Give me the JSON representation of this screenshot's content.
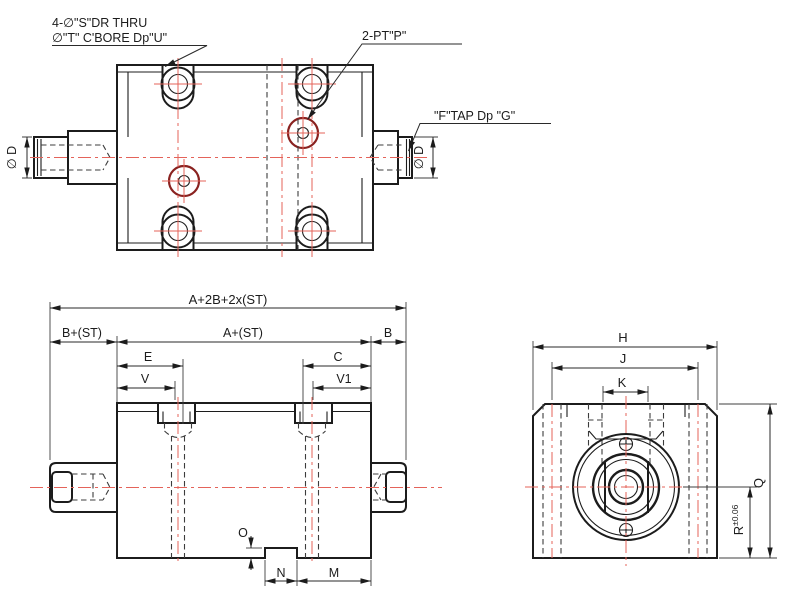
{
  "colors": {
    "line": "#1c1c1c",
    "centerline": "#e4635a",
    "hidden_line": "#3c3c3c",
    "port_highlight": "#8a2220",
    "background": "#ffffff"
  },
  "top_view": {
    "drill_note_line1": "4-∅\"S\"DR THRU",
    "drill_note_line2": "∅\"T\" C'BORE Dp\"U\"",
    "port_note": "2-PT\"P\"",
    "tap_note": "\"F\"TAP Dp \"G\"",
    "dia_label_left": "∅ D",
    "dia_label_right": "∅ D"
  },
  "front_view": {
    "dim_total": "A+2B+2x(ST)",
    "dim_left_end": "B+(ST)",
    "dim_body": "A+(ST)",
    "dim_right_end": "B",
    "dim_e": "E",
    "dim_c": "C",
    "dim_v": "V",
    "dim_v1": "V1",
    "dim_o": "O",
    "dim_n": "N",
    "dim_m": "M"
  },
  "side_view": {
    "dim_h": "H",
    "dim_j": "J",
    "dim_k": "K",
    "dim_q": "Q",
    "dim_r": "R",
    "dim_r_tol": "±0.06"
  }
}
